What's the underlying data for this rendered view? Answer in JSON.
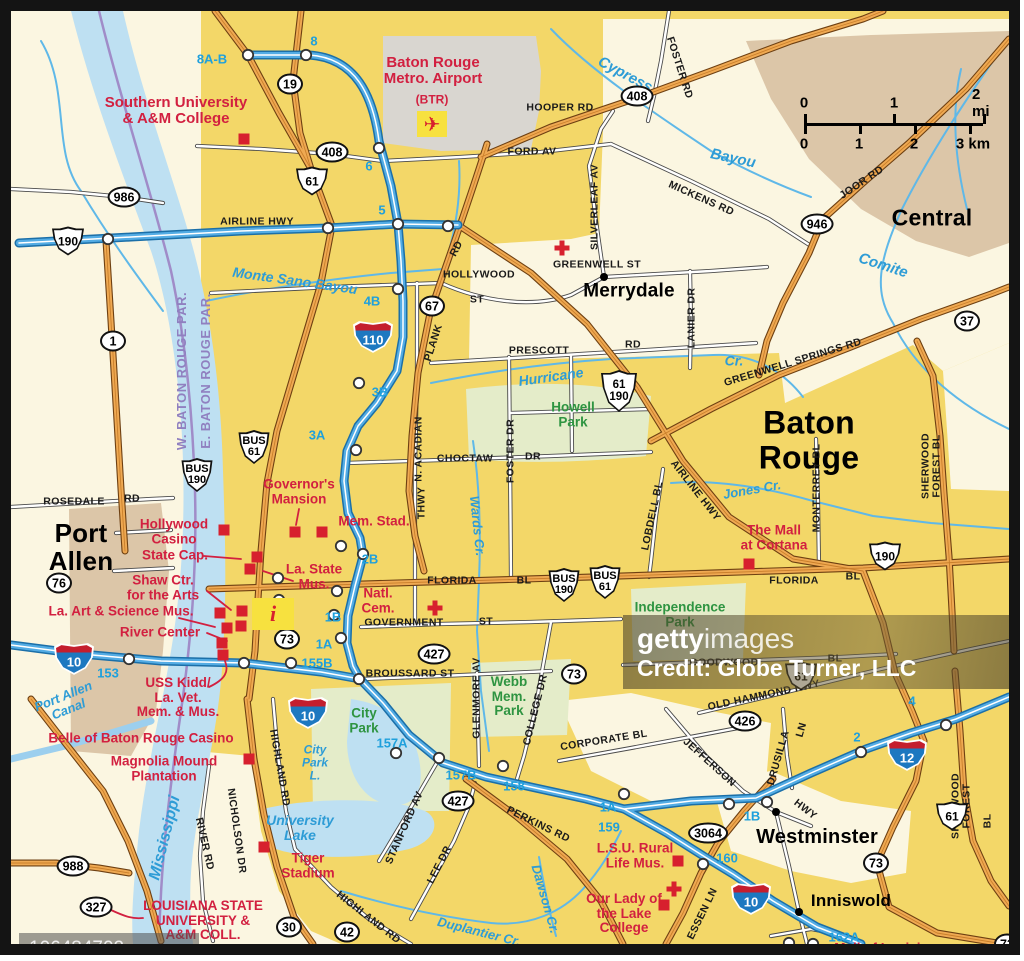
{
  "map_title": "Baton Rouge area map",
  "watermarks": {
    "getty_bold": "getty",
    "getty_light": "images",
    "credit": "Credit: Globe Turner, LLC",
    "image_id": "106484702"
  },
  "scale_bar": {
    "mi_labels": [
      "0",
      "1",
      "2 mi"
    ],
    "km_labels": [
      "0",
      "1",
      "2",
      "3 km"
    ]
  },
  "labels": [
    {
      "t": "Port\nAllen",
      "x": 70,
      "y": 536,
      "c": "city",
      "s": 26
    },
    {
      "t": "Merrydale",
      "x": 618,
      "y": 281,
      "c": "city",
      "s": 19
    },
    {
      "t": "Baton Rouge",
      "x": 798,
      "y": 429,
      "c": "city",
      "s": 32
    },
    {
      "t": "Central",
      "x": 921,
      "y": 207,
      "c": "city",
      "s": 23
    },
    {
      "t": "Westminster",
      "x": 806,
      "y": 827,
      "c": "city",
      "s": 20
    },
    {
      "t": "Inniswold",
      "x": 840,
      "y": 890,
      "c": "city",
      "s": 17
    },
    {
      "t": "Southern University\n& A&M College",
      "x": 165,
      "y": 100,
      "c": "poi",
      "s": 15
    },
    {
      "t": "Baton Rouge\nMetro. Airport",
      "x": 422,
      "y": 60,
      "c": "poi",
      "s": 15
    },
    {
      "t": "(BTR)",
      "x": 421,
      "y": 89,
      "c": "poi",
      "s": 12
    },
    {
      "t": "Governor's\nMansion",
      "x": 288,
      "y": 481,
      "c": "poi"
    },
    {
      "t": "Mem. Stad.",
      "x": 363,
      "y": 511,
      "c": "poi"
    },
    {
      "t": "Hollywood\nCasino",
      "x": 163,
      "y": 521,
      "c": "poi"
    },
    {
      "t": "State Cap.",
      "x": 164,
      "y": 545,
      "c": "poi"
    },
    {
      "t": "Shaw Ctr.\nfor the Arts",
      "x": 152,
      "y": 577,
      "c": "poi"
    },
    {
      "t": "La. Art & Science Mus.",
      "x": 110,
      "y": 601,
      "c": "poi"
    },
    {
      "t": "River Center",
      "x": 149,
      "y": 622,
      "c": "poi"
    },
    {
      "t": "La. State\nMus.",
      "x": 303,
      "y": 566,
      "c": "poi"
    },
    {
      "t": "Natl.\nCem.",
      "x": 367,
      "y": 590,
      "c": "poi"
    },
    {
      "t": "USS Kidd/\nLa. Vet.\nMem. & Mus.",
      "x": 167,
      "y": 687,
      "c": "poi"
    },
    {
      "t": "Belle of Baton Rouge Casino",
      "x": 130,
      "y": 728,
      "c": "poi"
    },
    {
      "t": "Magnolia Mound\nPlantation",
      "x": 153,
      "y": 758,
      "c": "poi"
    },
    {
      "t": "Tiger\nStadium",
      "x": 297,
      "y": 855,
      "c": "poi"
    },
    {
      "t": "LOUISIANA STATE\nUNIVERSITY &\nA&M COLL.",
      "x": 192,
      "y": 910,
      "c": "poi"
    },
    {
      "t": "The Mall\nat Cortana",
      "x": 763,
      "y": 527,
      "c": "poi"
    },
    {
      "t": "L.S.U. Rural\nLife Mus.",
      "x": 624,
      "y": 845,
      "c": "poi"
    },
    {
      "t": "Our Lady of\nthe Lake\nCollege",
      "x": 613,
      "y": 903,
      "c": "poi"
    },
    {
      "t": "Mall of Louisiana",
      "x": 878,
      "y": 938,
      "c": "poi"
    },
    {
      "t": "AIRLINE HWY",
      "x": 246,
      "y": 211,
      "c": "road"
    },
    {
      "t": "HOOPER RD",
      "x": 549,
      "y": 97,
      "c": "road"
    },
    {
      "t": "FOSTER RD",
      "x": 668,
      "y": 57,
      "c": "road",
      "r": 72
    },
    {
      "t": "FORD AV",
      "x": 521,
      "y": 141,
      "c": "road"
    },
    {
      "t": "MICKENS RD",
      "x": 690,
      "y": 188,
      "c": "road",
      "r": 24
    },
    {
      "t": "SILVERLEAF AV",
      "x": 584,
      "y": 196,
      "c": "road",
      "r": -90
    },
    {
      "t": "GREENWELL ST",
      "x": 586,
      "y": 254,
      "c": "road"
    },
    {
      "t": "LANIER DR",
      "x": 681,
      "y": 307,
      "c": "road",
      "r": -90
    },
    {
      "t": "JOOR RD",
      "x": 851,
      "y": 172,
      "c": "road",
      "r": -34
    },
    {
      "t": "HOLLYWOOD",
      "x": 468,
      "y": 264,
      "c": "road"
    },
    {
      "t": "ST",
      "x": 466,
      "y": 289,
      "c": "road"
    },
    {
      "t": "RD",
      "x": 446,
      "y": 238,
      "c": "road",
      "r": -62
    },
    {
      "t": "PLANK",
      "x": 423,
      "y": 332,
      "c": "road",
      "r": -72
    },
    {
      "t": "PRESCOTT",
      "x": 528,
      "y": 340,
      "c": "road"
    },
    {
      "t": "RD",
      "x": 622,
      "y": 334,
      "c": "road"
    },
    {
      "t": "N. ACADIAN",
      "x": 408,
      "y": 438,
      "c": "road",
      "r": -90
    },
    {
      "t": "THWY",
      "x": 411,
      "y": 492,
      "c": "road",
      "r": -90
    },
    {
      "t": "FOSTER DR",
      "x": 500,
      "y": 440,
      "c": "road",
      "r": -90
    },
    {
      "t": "CHOCTAW",
      "x": 454,
      "y": 448,
      "c": "road"
    },
    {
      "t": "DR",
      "x": 522,
      "y": 446,
      "c": "road"
    },
    {
      "t": "ROSEDALE",
      "x": 63,
      "y": 491,
      "c": "road"
    },
    {
      "t": "RD",
      "x": 121,
      "y": 488,
      "c": "road"
    },
    {
      "t": "GREENWELL SPRINGS RD",
      "x": 782,
      "y": 352,
      "c": "road",
      "r": -17
    },
    {
      "t": "FLORIDA",
      "x": 441,
      "y": 570,
      "c": "road"
    },
    {
      "t": "BL",
      "x": 513,
      "y": 570,
      "c": "road"
    },
    {
      "t": "FLORIDA",
      "x": 783,
      "y": 570,
      "c": "road"
    },
    {
      "t": "BL",
      "x": 842,
      "y": 566,
      "c": "road"
    },
    {
      "t": "GOVERNMENT",
      "x": 393,
      "y": 612,
      "c": "road"
    },
    {
      "t": "ST",
      "x": 475,
      "y": 611,
      "c": "road"
    },
    {
      "t": "BROUSSARD ST",
      "x": 399,
      "y": 663,
      "c": "road"
    },
    {
      "t": "GLENMORE AV",
      "x": 466,
      "y": 687,
      "c": "road",
      "r": -90
    },
    {
      "t": "COLLEGE DR",
      "x": 525,
      "y": 699,
      "c": "road",
      "r": -76
    },
    {
      "t": "CORPORATE BL",
      "x": 593,
      "y": 730,
      "c": "road",
      "r": -9
    },
    {
      "t": "GOODWOOD",
      "x": 713,
      "y": 652,
      "c": "road"
    },
    {
      "t": "BL",
      "x": 824,
      "y": 648,
      "c": "road"
    },
    {
      "t": "OLD HAMMOND HWY",
      "x": 753,
      "y": 685,
      "c": "road",
      "r": -12
    },
    {
      "t": "JEFFERSON",
      "x": 698,
      "y": 752,
      "c": "road",
      "r": 42
    },
    {
      "t": "HWY",
      "x": 794,
      "y": 799,
      "c": "road",
      "r": 38
    },
    {
      "t": "DRUSILLA",
      "x": 768,
      "y": 747,
      "c": "road",
      "r": -74
    },
    {
      "t": "LN",
      "x": 791,
      "y": 719,
      "c": "road",
      "r": -74
    },
    {
      "t": "MONTERREY BL",
      "x": 806,
      "y": 477,
      "c": "road",
      "r": -90
    },
    {
      "t": "LOBDELL BL",
      "x": 642,
      "y": 505,
      "c": "road",
      "r": -78
    },
    {
      "t": "AIRLINE HWY",
      "x": 684,
      "y": 480,
      "c": "road",
      "r": 52
    },
    {
      "t": "SHERWOOD FOREST BL",
      "x": 921,
      "y": 455,
      "c": "road",
      "r": -90
    },
    {
      "t": "SHERWOOD FOREST",
      "x": 951,
      "y": 795,
      "c": "road",
      "r": -90
    },
    {
      "t": "BL",
      "x": 977,
      "y": 810,
      "c": "road",
      "r": -90
    },
    {
      "t": "ESSEN LN",
      "x": 692,
      "y": 903,
      "c": "road",
      "r": -64
    },
    {
      "t": "HIGHLAND RD",
      "x": 268,
      "y": 757,
      "c": "road",
      "r": 80
    },
    {
      "t": "HIGHLAND RD",
      "x": 357,
      "y": 907,
      "c": "road",
      "r": 38
    },
    {
      "t": "NICHOLSON DR",
      "x": 225,
      "y": 820,
      "c": "road",
      "r": 82
    },
    {
      "t": "RIVER RD",
      "x": 193,
      "y": 833,
      "c": "road",
      "r": 77
    },
    {
      "t": "STANFORD AV",
      "x": 394,
      "y": 817,
      "c": "road",
      "r": -66
    },
    {
      "t": "LEE DR",
      "x": 429,
      "y": 854,
      "c": "road",
      "r": -63
    },
    {
      "t": "PERKINS RD",
      "x": 527,
      "y": 814,
      "c": "road",
      "r": 26
    },
    {
      "t": "Cypress",
      "x": 614,
      "y": 64,
      "c": "water",
      "r": 28,
      "s": 15
    },
    {
      "t": "Bayou",
      "x": 722,
      "y": 148,
      "c": "water",
      "r": 12,
      "s": 15
    },
    {
      "t": "Comite",
      "x": 872,
      "y": 255,
      "c": "water",
      "r": 18,
      "s": 15
    },
    {
      "t": "Monte Sano Bayou",
      "x": 284,
      "y": 270,
      "c": "water",
      "r": 8,
      "s": 14
    },
    {
      "t": "Hurricane",
      "x": 540,
      "y": 366,
      "c": "water",
      "r": -8,
      "s": 14
    },
    {
      "t": "Cr.",
      "x": 723,
      "y": 350,
      "c": "water",
      "s": 14
    },
    {
      "t": "Jones Cr.",
      "x": 741,
      "y": 479,
      "c": "water",
      "r": -10,
      "s": 13
    },
    {
      "t": "Wards Cr.",
      "x": 466,
      "y": 515,
      "c": "water",
      "r": 84,
      "s": 13
    },
    {
      "t": "Port Allen\nCanal",
      "x": 55,
      "y": 692,
      "c": "water",
      "r": -22,
      "s": 13
    },
    {
      "t": "Mississippi",
      "x": 154,
      "y": 827,
      "c": "water",
      "r": -76,
      "s": 16
    },
    {
      "t": "City\nPark\nL.",
      "x": 304,
      "y": 752,
      "c": "water",
      "s": 12
    },
    {
      "t": "University\nLake",
      "x": 289,
      "y": 817,
      "c": "water",
      "s": 14
    },
    {
      "t": "Duplantier Cr.",
      "x": 468,
      "y": 921,
      "c": "water",
      "r": 14,
      "s": 13
    },
    {
      "t": "Dawson Cr.",
      "x": 534,
      "y": 888,
      "c": "water",
      "r": 74,
      "s": 13
    },
    {
      "t": "Howell\nPark",
      "x": 562,
      "y": 404,
      "c": "park"
    },
    {
      "t": "Independence\nPark",
      "x": 669,
      "y": 604,
      "c": "park"
    },
    {
      "t": "Webb\nMem.\nPark",
      "x": 498,
      "y": 686,
      "c": "park"
    },
    {
      "t": "City\nPark",
      "x": 353,
      "y": 710,
      "c": "park"
    },
    {
      "t": "W. BATON ROUGE PAR.",
      "x": 171,
      "y": 360,
      "c": "parish",
      "r": -90
    },
    {
      "t": "E. BATON ROUGE PAR.",
      "x": 195,
      "y": 360,
      "c": "parish",
      "r": -90
    }
  ],
  "exits": [
    {
      "t": "8A-B",
      "x": 201,
      "y": 48
    },
    {
      "t": "8",
      "x": 303,
      "y": 30
    },
    {
      "t": "6",
      "x": 358,
      "y": 155
    },
    {
      "t": "5",
      "x": 371,
      "y": 199
    },
    {
      "t": "4B",
      "x": 361,
      "y": 290
    },
    {
      "t": "3B",
      "x": 369,
      "y": 381
    },
    {
      "t": "3A",
      "x": 306,
      "y": 424
    },
    {
      "t": "2B",
      "x": 359,
      "y": 548
    },
    {
      "t": "1B",
      "x": 322,
      "y": 606
    },
    {
      "t": "1A",
      "x": 313,
      "y": 633
    },
    {
      "t": "155B",
      "x": 306,
      "y": 652
    },
    {
      "t": "153",
      "x": 97,
      "y": 662
    },
    {
      "t": "157A",
      "x": 381,
      "y": 732
    },
    {
      "t": "157B",
      "x": 450,
      "y": 764
    },
    {
      "t": "158",
      "x": 503,
      "y": 775
    },
    {
      "t": "1A",
      "x": 597,
      "y": 796
    },
    {
      "t": "159",
      "x": 598,
      "y": 816
    },
    {
      "t": "1B",
      "x": 741,
      "y": 805
    },
    {
      "t": "160",
      "x": 716,
      "y": 847
    },
    {
      "t": "2",
      "x": 846,
      "y": 726
    },
    {
      "t": "4",
      "x": 901,
      "y": 690
    },
    {
      "t": "162A",
      "x": 833,
      "y": 926
    }
  ],
  "shields": [
    {
      "k": "oval",
      "t": "19",
      "x": 279,
      "y": 73
    },
    {
      "k": "oval",
      "t": "408",
      "x": 321,
      "y": 141
    },
    {
      "k": "oval",
      "t": "408",
      "x": 626,
      "y": 85
    },
    {
      "k": "oval",
      "t": "986",
      "x": 113,
      "y": 186
    },
    {
      "k": "us",
      "t": "190",
      "x": 57,
      "y": 230
    },
    {
      "k": "us",
      "t": "61",
      "x": 301,
      "y": 170
    },
    {
      "k": "oval",
      "t": "946",
      "x": 806,
      "y": 213
    },
    {
      "k": "oval",
      "t": "1",
      "x": 102,
      "y": 330
    },
    {
      "k": "oval",
      "t": "37",
      "x": 956,
      "y": 310
    },
    {
      "k": "oval",
      "t": "67",
      "x": 421,
      "y": 295
    },
    {
      "k": "us2",
      "t": "61\n190",
      "x": 608,
      "y": 380
    },
    {
      "k": "bus",
      "t": "BUS\n61",
      "x": 243,
      "y": 436
    },
    {
      "k": "bus",
      "t": "BUS\n190",
      "x": 186,
      "y": 464
    },
    {
      "k": "i",
      "t": "110",
      "x": 362,
      "y": 326
    },
    {
      "k": "oval",
      "t": "76",
      "x": 48,
      "y": 572
    },
    {
      "k": "bus",
      "t": "BUS\n190",
      "x": 553,
      "y": 574
    },
    {
      "k": "bus",
      "t": "BUS\n61",
      "x": 594,
      "y": 571
    },
    {
      "k": "us",
      "t": "190",
      "x": 874,
      "y": 545
    },
    {
      "k": "i",
      "t": "10",
      "x": 63,
      "y": 648
    },
    {
      "k": "oval",
      "t": "73",
      "x": 276,
      "y": 628
    },
    {
      "k": "oval",
      "t": "427",
      "x": 423,
      "y": 643
    },
    {
      "k": "oval",
      "t": "73",
      "x": 563,
      "y": 663
    },
    {
      "k": "i",
      "t": "10",
      "x": 297,
      "y": 702
    },
    {
      "k": "us",
      "t": "61",
      "x": 790,
      "y": 665
    },
    {
      "k": "oval",
      "t": "426",
      "x": 734,
      "y": 710
    },
    {
      "k": "i",
      "t": "12",
      "x": 896,
      "y": 744
    },
    {
      "k": "oval",
      "t": "3064",
      "x": 697,
      "y": 822
    },
    {
      "k": "us",
      "t": "61",
      "x": 941,
      "y": 805
    },
    {
      "k": "oval",
      "t": "73",
      "x": 865,
      "y": 852
    },
    {
      "k": "oval",
      "t": "73",
      "x": 996,
      "y": 933
    },
    {
      "k": "i",
      "t": "10",
      "x": 740,
      "y": 888
    },
    {
      "k": "oval",
      "t": "427",
      "x": 447,
      "y": 790
    },
    {
      "k": "oval",
      "t": "988",
      "x": 62,
      "y": 855
    },
    {
      "k": "oval",
      "t": "327",
      "x": 85,
      "y": 896
    },
    {
      "k": "oval",
      "t": "30",
      "x": 278,
      "y": 916
    },
    {
      "k": "oval",
      "t": "42",
      "x": 336,
      "y": 921
    }
  ],
  "markers": {
    "poi_squares": [
      [
        233,
        128
      ],
      [
        213,
        519
      ],
      [
        246,
        546
      ],
      [
        239,
        558
      ],
      [
        284,
        521
      ],
      [
        311,
        521
      ],
      [
        209,
        602
      ],
      [
        231,
        600
      ],
      [
        216,
        617
      ],
      [
        230,
        615
      ],
      [
        211,
        632
      ],
      [
        212,
        644
      ],
      [
        238,
        748
      ],
      [
        253,
        836
      ],
      [
        738,
        553
      ],
      [
        667,
        850
      ],
      [
        653,
        894
      ],
      [
        780,
        946
      ]
    ],
    "town_dots": [
      [
        593,
        266
      ],
      [
        765,
        801
      ],
      [
        788,
        901
      ]
    ],
    "hospital_crosses": [
      [
        551,
        237
      ],
      [
        424,
        597
      ],
      [
        663,
        878
      ]
    ],
    "info_point": [
      262,
      603
    ],
    "info_glyph": "i",
    "airport_point": [
      421,
      113
    ],
    "airplane_glyph": "✈"
  }
}
